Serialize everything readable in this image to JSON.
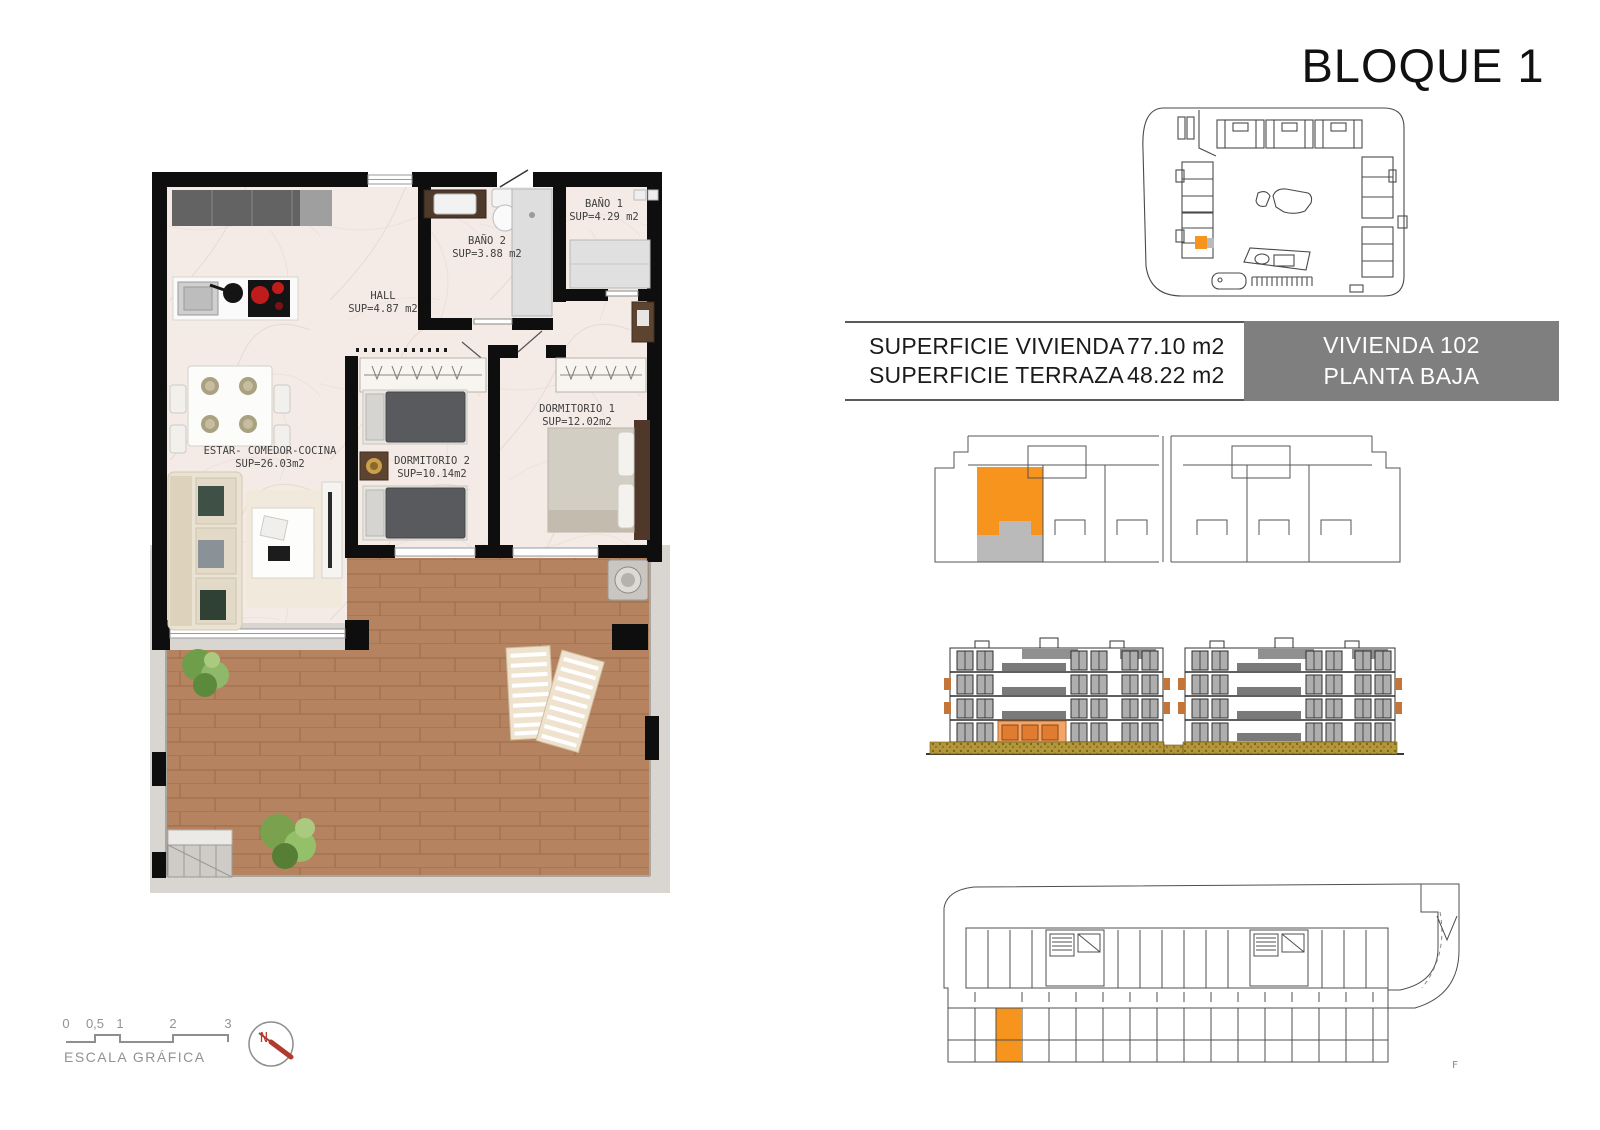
{
  "title": "BLOQUE 1",
  "info_table": {
    "row1_label": "SUPERFICIE VIVIENDA",
    "row1_value": "77.10 m2",
    "row2_label": "SUPERFICIE TERRAZA",
    "row2_value": "48.22 m2",
    "unit_name": "VIVIENDA 102",
    "unit_floor": "PLANTA BAJA"
  },
  "floor_plan": {
    "rooms": {
      "bano1": {
        "name": "BAÑO 1",
        "area": "SUP=4.29 m2"
      },
      "bano2": {
        "name": "BAÑO 2",
        "area": "SUP=3.88 m2"
      },
      "hall": {
        "name": "HALL",
        "area": "SUP=4.87 m2"
      },
      "dorm1": {
        "name": "DORMITORIO 1",
        "area": "SUP=12.02m2"
      },
      "dorm2": {
        "name": "DORMITORIO 2",
        "area": "SUP=10.14m2"
      },
      "estar": {
        "name": "ESTAR- COMEDOR-COCINA",
        "area": "SUP=26.03m2"
      }
    }
  },
  "scale_bar": {
    "tick0": "0",
    "tick05": "0,5",
    "tick1": "1",
    "tick2": "2",
    "tick3": "3",
    "label": "ESCALA GRÁFICA"
  },
  "compass": {
    "north": "N"
  },
  "garage_plan": {
    "corner_mark": "F"
  },
  "colors": {
    "highlight_orange": "#F7941E",
    "terrace_gray": "#BABABA",
    "unit_box_gray": "#7F7F7F",
    "ground_floor_orange": "#F2A567",
    "door_orange": "#E07B2F",
    "hedge_olive": "#B3973A",
    "compass_red": "#B03A2E"
  }
}
